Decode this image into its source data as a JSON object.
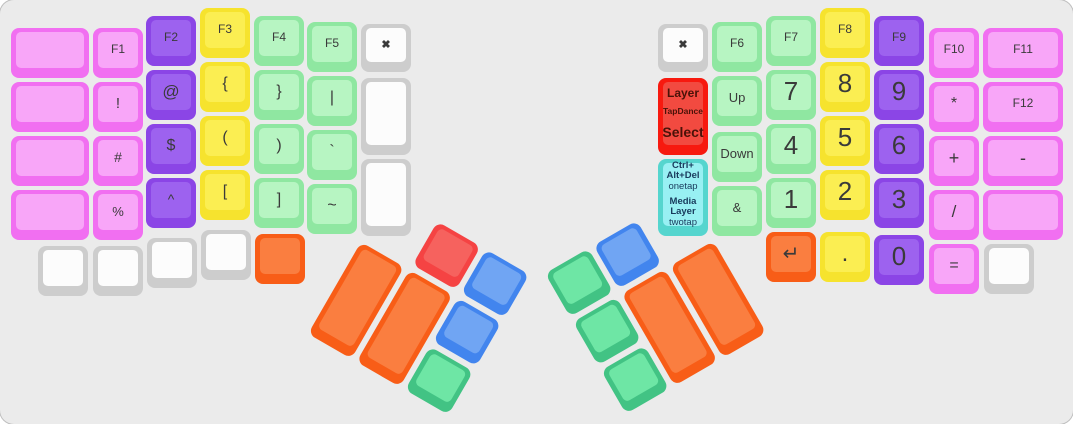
{
  "canvas": {
    "bg": "#ebebeb",
    "label_color": "#3a3a3a"
  },
  "palette": {
    "pink": {
      "edge": "#f16ff1",
      "face": "#f8a6f8"
    },
    "purple": {
      "edge": "#8b45e6",
      "face": "#9d62ef"
    },
    "yellow": {
      "edge": "#f6e32e",
      "face": "#fbee52"
    },
    "green": {
      "edge": "#8fe7a1",
      "face": "#b7f5c2"
    },
    "white": {
      "edge": "#cdcdcd",
      "face": "#fcfcfc"
    },
    "red": {
      "edge": "#f7190f",
      "face": "#f24a40",
      "text": "#4a1208"
    },
    "cyan": {
      "edge": "#55d5ce",
      "face": "#98f0f3",
      "text": "#183a5c"
    },
    "orange": {
      "edge": "#f85d17",
      "face": "#fa7e40"
    },
    "tred": {
      "edge": "#f54343",
      "face": "#f6625e"
    },
    "blue": {
      "edge": "#4285ee",
      "face": "#70a5f3"
    },
    "tgreen": {
      "edge": "#42c384",
      "face": "#6ee6a5"
    }
  },
  "keys": [
    {
      "n": "key-blank-left-outer-r1",
      "c": "pink",
      "x": 11,
      "y": 28,
      "w": 78
    },
    {
      "n": "key-blank-left-outer-r2",
      "c": "pink",
      "x": 11,
      "y": 82,
      "w": 78
    },
    {
      "n": "key-blank-left-outer-r3",
      "c": "pink",
      "x": 11,
      "y": 136,
      "w": 78
    },
    {
      "n": "key-blank-left-outer-r4",
      "c": "pink",
      "x": 11,
      "y": 190,
      "w": 78
    },
    {
      "n": "key-f1",
      "c": "pink",
      "x": 93,
      "y": 28,
      "t": "F1",
      "fs": 12
    },
    {
      "n": "key-exclamation",
      "c": "pink",
      "x": 93,
      "y": 82,
      "t": "!",
      "fs": 15
    },
    {
      "n": "key-hash",
      "c": "pink",
      "x": 93,
      "y": 136,
      "t": "#",
      "fs": 14
    },
    {
      "n": "key-percent",
      "c": "pink",
      "x": 93,
      "y": 190,
      "t": "%",
      "fs": 13
    },
    {
      "n": "key-f2",
      "c": "purple",
      "x": 146,
      "y": 16,
      "t": "F2",
      "fs": 12
    },
    {
      "n": "key-at",
      "c": "purple",
      "x": 146,
      "y": 70,
      "t": "@",
      "fs": 17
    },
    {
      "n": "key-dollar",
      "c": "purple",
      "x": 146,
      "y": 124,
      "t": "$",
      "fs": 16
    },
    {
      "n": "key-caret",
      "c": "purple",
      "x": 146,
      "y": 178,
      "t": "^",
      "fs": 14
    },
    {
      "n": "key-f3",
      "c": "yellow",
      "x": 200,
      "y": 8,
      "t": "F3",
      "fs": 12
    },
    {
      "n": "key-brace-open",
      "c": "yellow",
      "x": 200,
      "y": 62,
      "t": "{",
      "fs": 16
    },
    {
      "n": "key-paren-open",
      "c": "yellow",
      "x": 200,
      "y": 116,
      "t": "(",
      "fs": 16
    },
    {
      "n": "key-bracket-open",
      "c": "yellow",
      "x": 200,
      "y": 170,
      "t": "[",
      "fs": 16
    },
    {
      "n": "key-f4",
      "c": "green",
      "x": 254,
      "y": 16,
      "t": "F4",
      "fs": 12
    },
    {
      "n": "key-brace-close",
      "c": "green",
      "x": 254,
      "y": 70,
      "t": "}",
      "fs": 16
    },
    {
      "n": "key-paren-close",
      "c": "green",
      "x": 254,
      "y": 124,
      "t": ")",
      "fs": 16
    },
    {
      "n": "key-bracket-close",
      "c": "green",
      "x": 254,
      "y": 178,
      "t": "]",
      "fs": 16
    },
    {
      "n": "key-f5",
      "c": "green",
      "x": 307,
      "y": 22,
      "t": "F5",
      "fs": 12
    },
    {
      "n": "key-pipe",
      "c": "green",
      "x": 307,
      "y": 76,
      "t": "|",
      "fs": 16
    },
    {
      "n": "key-backtick",
      "c": "green",
      "x": 307,
      "y": 130,
      "t": "`",
      "fs": 16
    },
    {
      "n": "key-tilde",
      "c": "green",
      "x": 307,
      "y": 184,
      "t": "~",
      "fs": 16
    },
    {
      "n": "key-close-left",
      "c": "white",
      "x": 361,
      "y": 24,
      "h": 48,
      "t": "✖",
      "fs": 11,
      "b": true
    },
    {
      "n": "key-blank-left-inner-tall-1",
      "c": "white",
      "x": 361,
      "y": 78,
      "h": 77
    },
    {
      "n": "key-blank-left-inner-tall-2",
      "c": "white",
      "x": 361,
      "y": 159,
      "h": 77
    },
    {
      "n": "key-blank-left-bottom-1",
      "c": "white",
      "x": 38,
      "y": 246
    },
    {
      "n": "key-blank-left-bottom-2",
      "c": "white",
      "x": 93,
      "y": 246
    },
    {
      "n": "key-blank-left-bottom-3",
      "c": "white",
      "x": 147,
      "y": 238
    },
    {
      "n": "key-blank-left-bottom-4",
      "c": "white",
      "x": 201,
      "y": 230
    },
    {
      "n": "key-blank-left-bottom-orange",
      "c": "orange",
      "x": 255,
      "y": 234
    },
    {
      "n": "key-close-right",
      "c": "white",
      "x": 658,
      "y": 24,
      "h": 48,
      "t": "✖",
      "fs": 11,
      "b": true
    },
    {
      "n": "key-layer-tapdance-select",
      "c": "red",
      "x": 658,
      "y": 78,
      "h": 77,
      "lines": [
        {
          "text": "Layer",
          "size": 12,
          "bold": true
        },
        {
          "text": "TapDance",
          "size": 8.5,
          "bold": true,
          "mt": 7
        },
        {
          "text": "Select",
          "size": 14,
          "bold": true,
          "mt": 8
        }
      ]
    },
    {
      "n": "key-ctrl-alt-del-media-layer",
      "c": "cyan",
      "x": 658,
      "y": 159,
      "h": 77,
      "lines": [
        {
          "text": "Ctrl+",
          "size": 9.5,
          "bold": true
        },
        {
          "text": "Alt+Del",
          "size": 9.5,
          "bold": true
        },
        {
          "text": "onetap",
          "size": 9.5,
          "bold": false
        },
        {
          "text": "Media",
          "size": 9.5,
          "bold": true,
          "mt": 4
        },
        {
          "text": "Layer",
          "size": 9.5,
          "bold": true
        },
        {
          "text": "twotap",
          "size": 9.5,
          "bold": false
        }
      ]
    },
    {
      "n": "key-f6",
      "c": "green",
      "x": 712,
      "y": 22,
      "t": "F6",
      "fs": 12
    },
    {
      "n": "key-up",
      "c": "green",
      "x": 712,
      "y": 76,
      "t": "Up",
      "fs": 13
    },
    {
      "n": "key-down",
      "c": "green",
      "x": 712,
      "y": 132,
      "t": "Down",
      "fs": 13
    },
    {
      "n": "key-ampersand",
      "c": "green",
      "x": 712,
      "y": 186,
      "t": "&",
      "fs": 13
    },
    {
      "n": "key-f7",
      "c": "green",
      "x": 766,
      "y": 16,
      "t": "F7",
      "fs": 12
    },
    {
      "n": "key-num-7",
      "c": "green",
      "x": 766,
      "y": 70,
      "t": "7",
      "fs": 26
    },
    {
      "n": "key-num-4",
      "c": "green",
      "x": 766,
      "y": 124,
      "t": "4",
      "fs": 26
    },
    {
      "n": "key-num-1",
      "c": "green",
      "x": 766,
      "y": 178,
      "t": "1",
      "fs": 26
    },
    {
      "n": "key-enter",
      "c": "orange",
      "x": 766,
      "y": 232,
      "t": "↵",
      "fs": 20
    },
    {
      "n": "key-f8",
      "c": "yellow",
      "x": 820,
      "y": 8,
      "t": "F8",
      "fs": 12
    },
    {
      "n": "key-num-8",
      "c": "yellow",
      "x": 820,
      "y": 62,
      "t": "8",
      "fs": 26
    },
    {
      "n": "key-num-5",
      "c": "yellow",
      "x": 820,
      "y": 116,
      "t": "5",
      "fs": 26
    },
    {
      "n": "key-num-2",
      "c": "yellow",
      "x": 820,
      "y": 170,
      "t": "2",
      "fs": 26
    },
    {
      "n": "key-period",
      "c": "yellow",
      "x": 820,
      "y": 232,
      "t": ".",
      "fs": 24
    },
    {
      "n": "key-f9",
      "c": "purple",
      "x": 874,
      "y": 16,
      "t": "F9",
      "fs": 12
    },
    {
      "n": "key-num-9",
      "c": "purple",
      "x": 874,
      "y": 70,
      "t": "9",
      "fs": 26
    },
    {
      "n": "key-num-6",
      "c": "purple",
      "x": 874,
      "y": 124,
      "t": "6",
      "fs": 26
    },
    {
      "n": "key-num-3",
      "c": "purple",
      "x": 874,
      "y": 178,
      "t": "3",
      "fs": 26
    },
    {
      "n": "key-num-0",
      "c": "purple",
      "x": 874,
      "y": 235,
      "t": "0",
      "fs": 26
    },
    {
      "n": "key-f10",
      "c": "pink",
      "x": 929,
      "y": 28,
      "t": "F10",
      "fs": 12
    },
    {
      "n": "key-asterisk",
      "c": "pink",
      "x": 929,
      "y": 82,
      "t": "*",
      "fs": 16
    },
    {
      "n": "key-plus",
      "c": "pink",
      "x": 929,
      "y": 136,
      "t": "+",
      "fs": 18
    },
    {
      "n": "key-slash",
      "c": "pink",
      "x": 929,
      "y": 190,
      "t": "/",
      "fs": 17
    },
    {
      "n": "key-equals",
      "c": "pink",
      "x": 929,
      "y": 244,
      "t": "=",
      "fs": 16
    },
    {
      "n": "key-f11",
      "c": "pink",
      "x": 983,
      "y": 28,
      "w": 80,
      "t": "F11",
      "fs": 12
    },
    {
      "n": "key-f12",
      "c": "pink",
      "x": 983,
      "y": 82,
      "w": 80,
      "t": "F12",
      "fs": 12
    },
    {
      "n": "key-minus",
      "c": "pink",
      "x": 983,
      "y": 136,
      "w": 80,
      "t": "-",
      "fs": 18
    },
    {
      "n": "key-blank-right-outer",
      "c": "pink",
      "x": 983,
      "y": 190,
      "w": 80
    },
    {
      "n": "key-blank-right-bottom",
      "c": "white",
      "x": 984,
      "y": 244
    }
  ],
  "clusters": [
    {
      "name": "left-thumb-cluster",
      "x": 361,
      "y": 242,
      "angle": 30,
      "keys": [
        {
          "n": "left-thumb-big-1",
          "c": "orange",
          "x": 0,
          "y": 0,
          "w": 50,
          "h": 106
        },
        {
          "n": "left-thumb-big-2",
          "c": "orange",
          "x": 56,
          "y": 0,
          "w": 50,
          "h": 106
        },
        {
          "n": "left-thumb-red",
          "c": "tred",
          "x": 56,
          "y": -56
        },
        {
          "n": "left-thumb-blue-top",
          "c": "blue",
          "x": 112,
          "y": -56
        },
        {
          "n": "left-thumb-blue-mid",
          "c": "blue",
          "x": 112,
          "y": 0
        },
        {
          "n": "left-thumb-green",
          "c": "tgreen",
          "x": 112,
          "y": 56
        }
      ]
    },
    {
      "name": "right-thumb-cluster",
      "x": 573,
      "y": 322,
      "angle": -30,
      "keys": [
        {
          "n": "right-thumb-green-top",
          "c": "tgreen",
          "x": 0,
          "y": -56
        },
        {
          "n": "right-thumb-blue-top",
          "c": "blue",
          "x": 56,
          "y": -56
        },
        {
          "n": "right-thumb-green-mid",
          "c": "tgreen",
          "x": 0,
          "y": 0
        },
        {
          "n": "right-thumb-green-bottom",
          "c": "tgreen",
          "x": 0,
          "y": 56
        },
        {
          "n": "right-thumb-big-1",
          "c": "orange",
          "x": 56,
          "y": 0,
          "w": 50,
          "h": 106
        },
        {
          "n": "right-thumb-big-2",
          "c": "orange",
          "x": 112,
          "y": 0,
          "w": 50,
          "h": 106
        }
      ]
    }
  ]
}
